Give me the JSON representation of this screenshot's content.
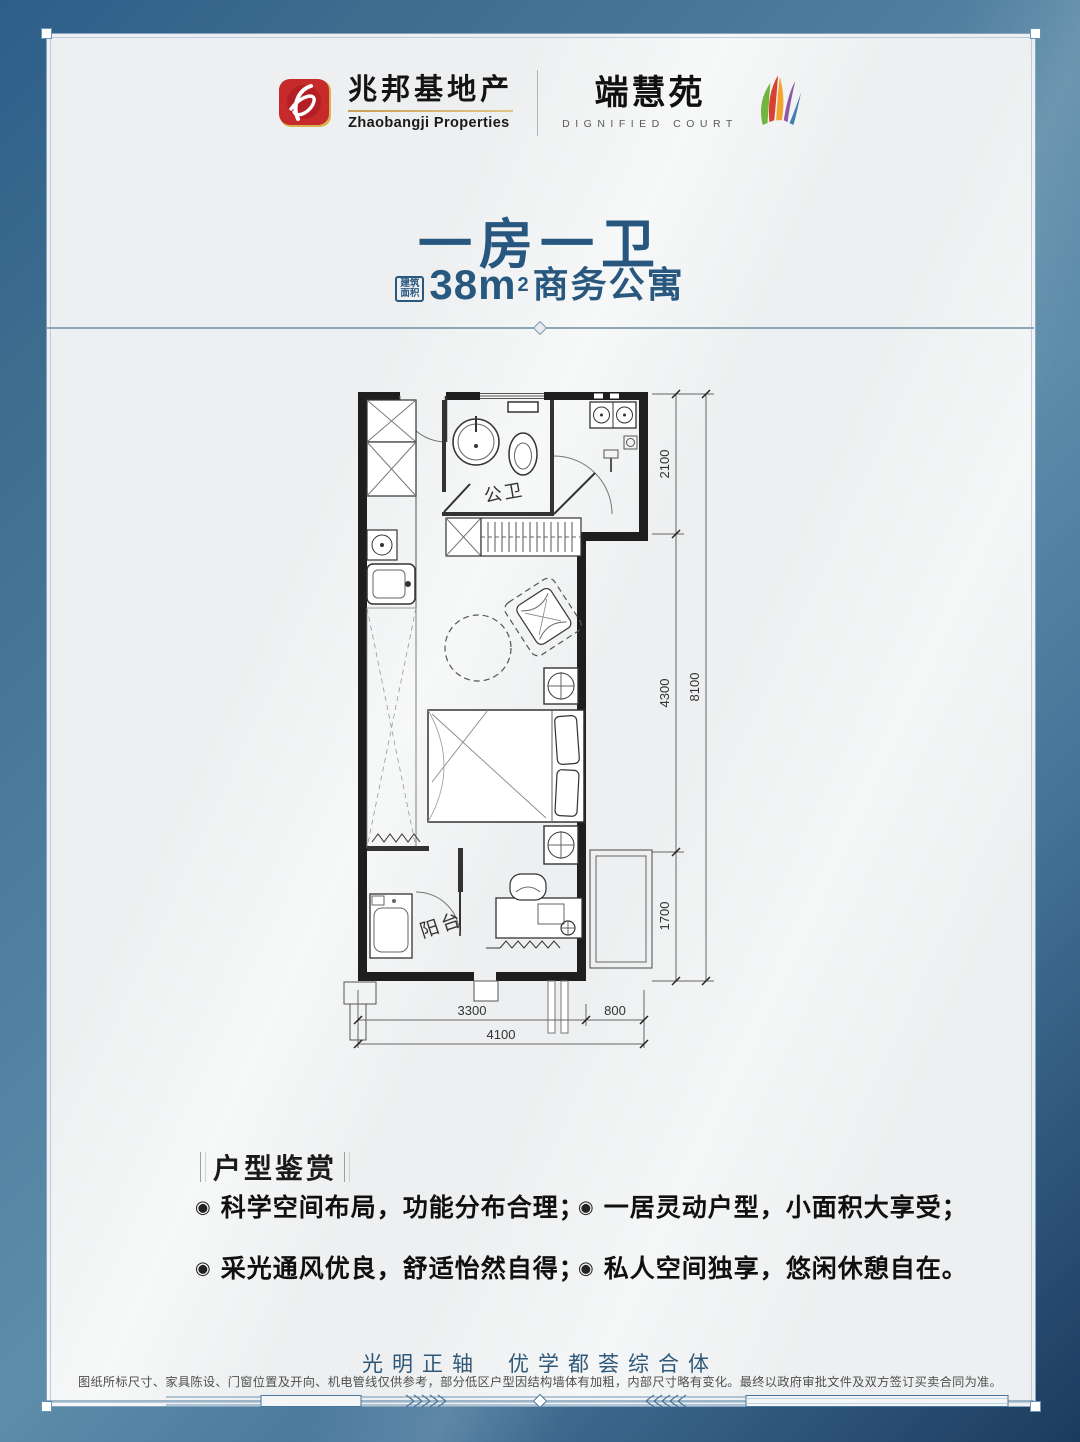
{
  "brand": {
    "developer_cn": "兆邦基地产",
    "developer_en": "Zhaobangji Properties",
    "project_cn": "端慧苑",
    "project_en": "DIGNIFIED COURT"
  },
  "unit": {
    "title": "一房一卫",
    "area_tag_top": "建筑",
    "area_tag_bottom": "面积",
    "area_value": "38m",
    "area_sq": "2",
    "area_type": "商务公寓"
  },
  "floorplan": {
    "labels": {
      "bathroom": "公卫",
      "balcony": "阳台"
    },
    "dims": {
      "v1": "2100",
      "v2": "4300",
      "v3": "1700",
      "v_total": "8100",
      "h1": "3300",
      "h2": "800",
      "h_total": "4100"
    }
  },
  "features": {
    "heading": "户型鉴赏",
    "bullet_glyph": "◉",
    "bullets": [
      "科学空间布局，功能分布合理；",
      "采光通风优良，舒适怡然自得；",
      "一居灵动户型，小面积大享受；",
      "私人空间独享，悠闲休憩自在。"
    ]
  },
  "footer": {
    "tagline_left": "光明正轴",
    "tagline_right": "优学都荟综合体",
    "disclaimer": "图纸所标尺寸、家具陈设、门窗位置及开向、机电管线仅供参考，部分低区户型因结构墙体有加粗，内部尺寸略有变化。最终以政府审批文件及双方签订买卖合同为准。"
  },
  "colors": {
    "accent_blue": "#27567e",
    "brand_red": "#c62a2a",
    "brand_gold": "#c9a053",
    "frame_blue": "#6d93b2",
    "wall": "#1e1e1e"
  }
}
